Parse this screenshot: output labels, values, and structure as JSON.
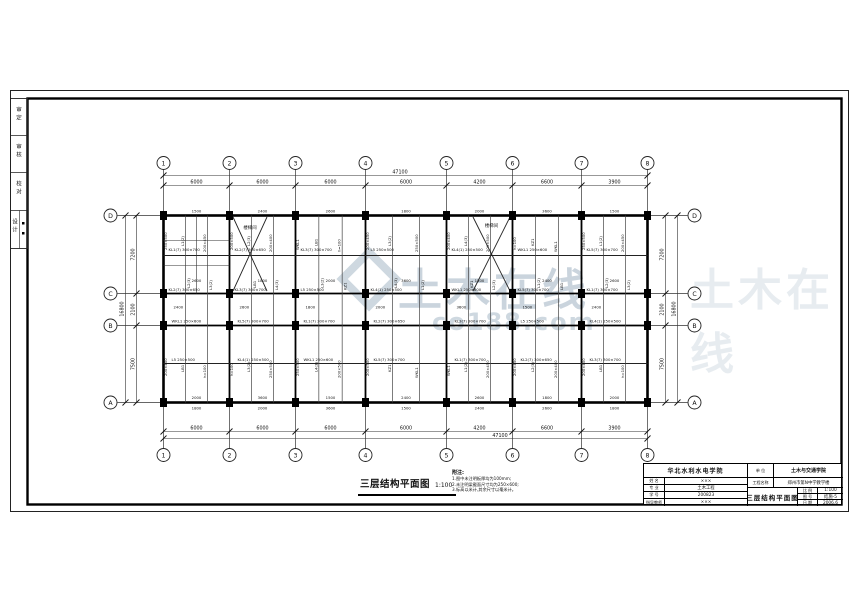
{
  "watermark": {
    "title": "土木在线",
    "subtitle": "co188.com"
  },
  "drawing_title": {
    "text": "三层结构平面图",
    "scale": "1:100"
  },
  "notes": {
    "heading": "附注:",
    "lines": [
      "1.图中未注明板厚均为100mm;",
      "2.未注明梁截面尺寸均为250×600;",
      "3.标高以米计,其余尺寸以毫米计。"
    ]
  },
  "axes": {
    "cols": [
      "1",
      "2",
      "3",
      "4",
      "5",
      "6",
      "7",
      "8"
    ],
    "rows": [
      "D",
      "C",
      "B",
      "A"
    ]
  },
  "dimensions": {
    "top_segments": [
      "6000",
      "6000",
      "6000",
      "6000",
      "4200",
      "6600",
      "3900"
    ],
    "top_total": "47100",
    "bottom_segments": [
      "6000",
      "6000",
      "6000",
      "6000",
      "4200",
      "6600",
      "3900"
    ],
    "bottom_total": "47100",
    "left_segments": [
      "7200",
      "2100",
      "7500"
    ],
    "left_total": "16800",
    "right_segments": [
      "7200",
      "2100",
      "7500"
    ],
    "right_total": "16800"
  },
  "stairwell_label": "楼梯间",
  "beam_labels": {
    "vertical_pool": [
      "L1(2)",
      "200×450",
      "L2(3)",
      "200×400",
      "LB1",
      "h=100",
      "L3(2)",
      "250×500",
      "L4(3)",
      "200×500",
      "KZ1",
      "WKL1"
    ],
    "horizontal_pool": [
      "KL1(7) 300×700",
      "KL2(7) 300×650",
      "KL3(7) 300×700",
      "L5 250×500",
      "KL4(1) 250×500",
      "WKL1 250×600",
      "KL5(7) 300×700"
    ],
    "span_numbers": [
      "2600",
      "1800",
      "2000",
      "3600",
      "1500",
      "2400"
    ]
  },
  "side_strip": {
    "cells": [
      "审定",
      "审核",
      "校对",
      "设计"
    ]
  },
  "title_block": {
    "org": "华北水利水电学院",
    "left_rows": [
      {
        "label": "姓 名",
        "value": "×××"
      },
      {
        "label": "专 业",
        "value": "土木工程"
      },
      {
        "label": "学 号",
        "value": "200823"
      },
      {
        "label": "指导教师",
        "value": "×××"
      }
    ],
    "unit_label": "单 位",
    "unit_value": "土木与交通学院",
    "project_label": "工程名称",
    "project_value": "郑州市第N中学教学楼",
    "sheet_title": "三层结构平面图",
    "meta_rows": [
      {
        "label": "比 例",
        "value": "1:100"
      },
      {
        "label": "图 号",
        "value": "结施-5"
      },
      {
        "label": "日 期",
        "value": "2006.6"
      }
    ]
  }
}
